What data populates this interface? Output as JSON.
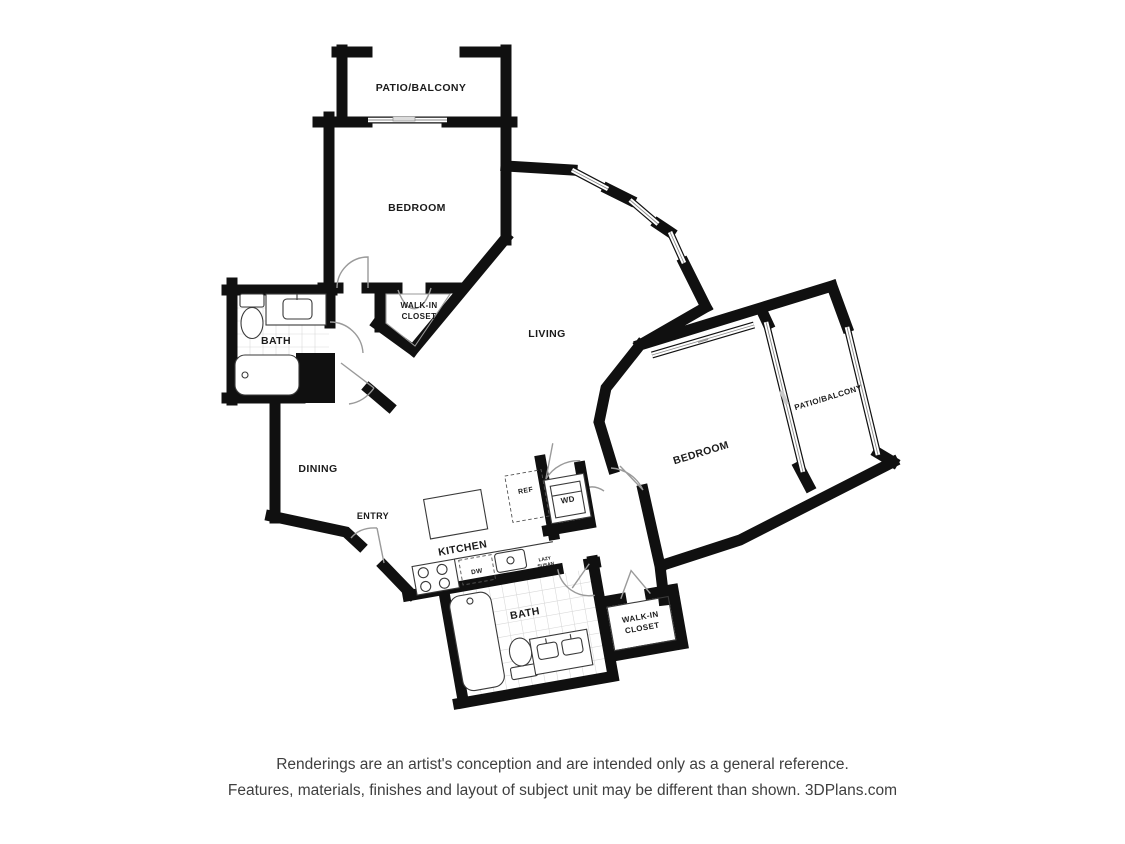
{
  "plan": {
    "type": "apartment-floor-plan",
    "colors": {
      "background": "#ffffff",
      "wall": "#101010",
      "label": "#1b1b1b",
      "door_arc": "#9a9a9a",
      "tile": "#d9d9d9",
      "footer_text": "#3f3f3f"
    },
    "rooms": {
      "patio_balcony_top": {
        "label": "PATIO/BALCONY"
      },
      "bedroom_top": {
        "label": "BEDROOM"
      },
      "walk_in_closet_top": {
        "line1": "WALK-IN",
        "line2": "CLOSET"
      },
      "bath_left": {
        "label": "BATH"
      },
      "living": {
        "label": "LIVING"
      },
      "dining": {
        "label": "DINING"
      },
      "entry": {
        "label": "ENTRY"
      },
      "kitchen": {
        "label": "KITCHEN"
      },
      "bath_bottom": {
        "label": "BATH"
      },
      "walk_in_closet_bottom": {
        "line1": "WALK-IN",
        "line2": "CLOSET"
      },
      "bedroom_right": {
        "label": "BEDROOM"
      },
      "patio_balcony_right": {
        "label": "PATIO/BALCONY"
      }
    },
    "fixtures": {
      "refrigerator": "REF",
      "dishwasher": "DW",
      "washer_dryer": "WD",
      "lazy_susan_line1": "LAZY",
      "lazy_susan_line2": "SUSAN"
    }
  },
  "footer": {
    "line1": "Renderings are an artist's conception and are intended only as a general reference.",
    "line2": "Features, materials, finishes and layout of subject unit may be different than shown. 3DPlans.com"
  }
}
